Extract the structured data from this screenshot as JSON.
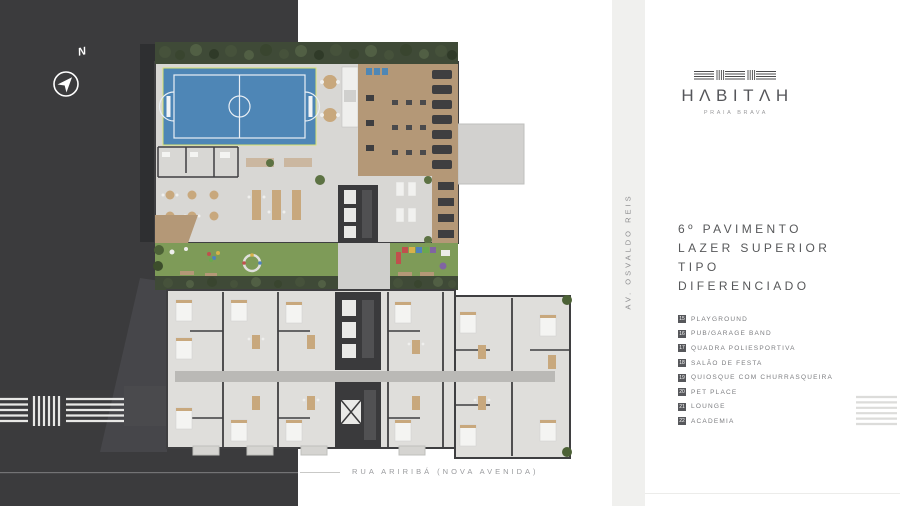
{
  "brand": {
    "name": "HΛBITΛH",
    "tagline": "PRAIA BRAVA"
  },
  "compass": {
    "label": "N"
  },
  "streets": {
    "avenue": "AV.  OSVALDO  REIS",
    "street": "RUA ARIRIBÁ (NOVA AVENIDA)"
  },
  "title": {
    "lines": [
      "6º PAVIMENTO",
      "LAZER SUPERIOR",
      "TIPO",
      "DIFERENCIADO"
    ]
  },
  "legend": {
    "items": [
      {
        "number": "15",
        "label": "PLAYGROUND"
      },
      {
        "number": "16",
        "label": "PUB/GARAGE BAND"
      },
      {
        "number": "17",
        "label": "QUADRA POLIESPORTIVA"
      },
      {
        "number": "18",
        "label": "SALÃO DE FESTA"
      },
      {
        "number": "19",
        "label": "QUIOSQUE COM CHURRASQUEIRA"
      },
      {
        "number": "20",
        "label": "PET PLACE"
      },
      {
        "number": "21",
        "label": "LOUNGE"
      },
      {
        "number": "22",
        "label": "ACADEMIA"
      }
    ]
  },
  "colors": {
    "backdrop_dark": "#3B3B3D",
    "paper_white": "#FFFFFF",
    "avenue_strip": "#F0F0EE",
    "court_blue": "#4E86B6",
    "deck_wood": "#B49877",
    "lawn_green": "#7E9B58",
    "hedge_green": "#3F4A37",
    "ink_gray": "#57585A"
  }
}
